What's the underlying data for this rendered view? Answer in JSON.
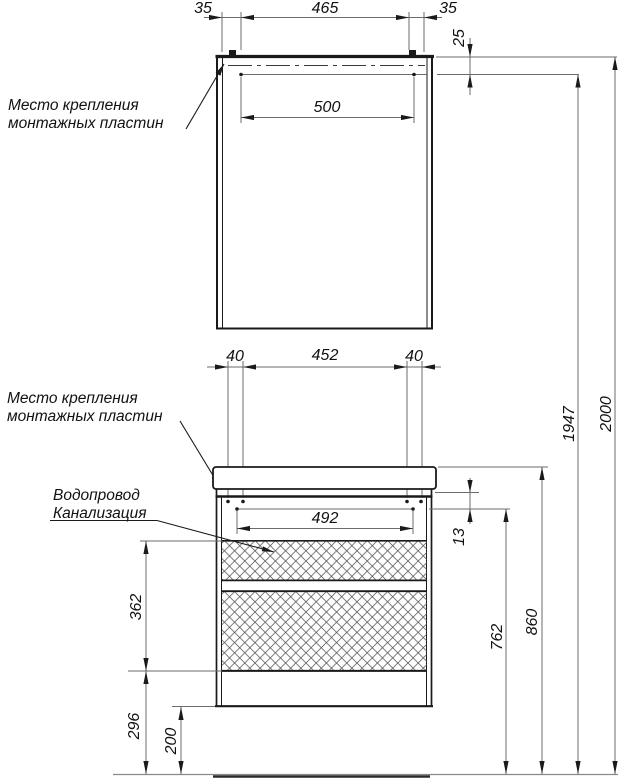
{
  "drawing": {
    "type": "furniture-installation-dimension-diagram",
    "labels": {
      "mount_top": [
        "Место крепления",
        "монтажных пластин"
      ],
      "mount_mid": [
        "Место крепления",
        "монтажных пластин"
      ],
      "utilities": [
        "Водопровод",
        "Канализация"
      ]
    },
    "dims": {
      "d35l": "35",
      "d465": "465",
      "d35r": "35",
      "d25": "25",
      "d500": "500",
      "d40l": "40",
      "d452": "452",
      "d40r": "40",
      "d492": "492",
      "d13": "13",
      "d362": "362",
      "d296": "296",
      "d200": "200",
      "d762": "762",
      "d860": "860",
      "d1947": "1947",
      "d2000": "2000"
    },
    "colors": {
      "object_line": "#1a1a1a",
      "dim_line": "#6b6b6b",
      "text": "#111111",
      "background": "#ffffff"
    }
  }
}
